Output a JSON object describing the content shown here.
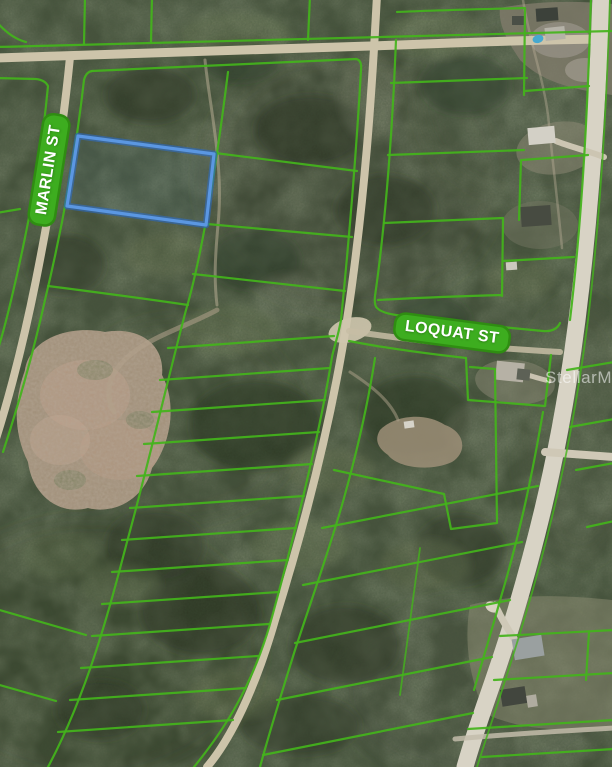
{
  "map": {
    "street_labels": [
      {
        "id": "marlin",
        "text": "MARLIN ST"
      },
      {
        "id": "loquat",
        "text": "LOQUAT ST"
      }
    ],
    "watermark_text": "StellarMLS",
    "highlighted_parcel": {
      "description": "blue outlined lot at Marlin St"
    },
    "colors": {
      "parcel_line": "#44b41c",
      "label_bg": "#3dad1f",
      "label_border": "#2f8d12",
      "highlight": "#5b97e2",
      "highlight_dark": "#2f66b0",
      "road_dirt": "#cdc4aa",
      "road_paved": "#d8d3c5"
    }
  }
}
